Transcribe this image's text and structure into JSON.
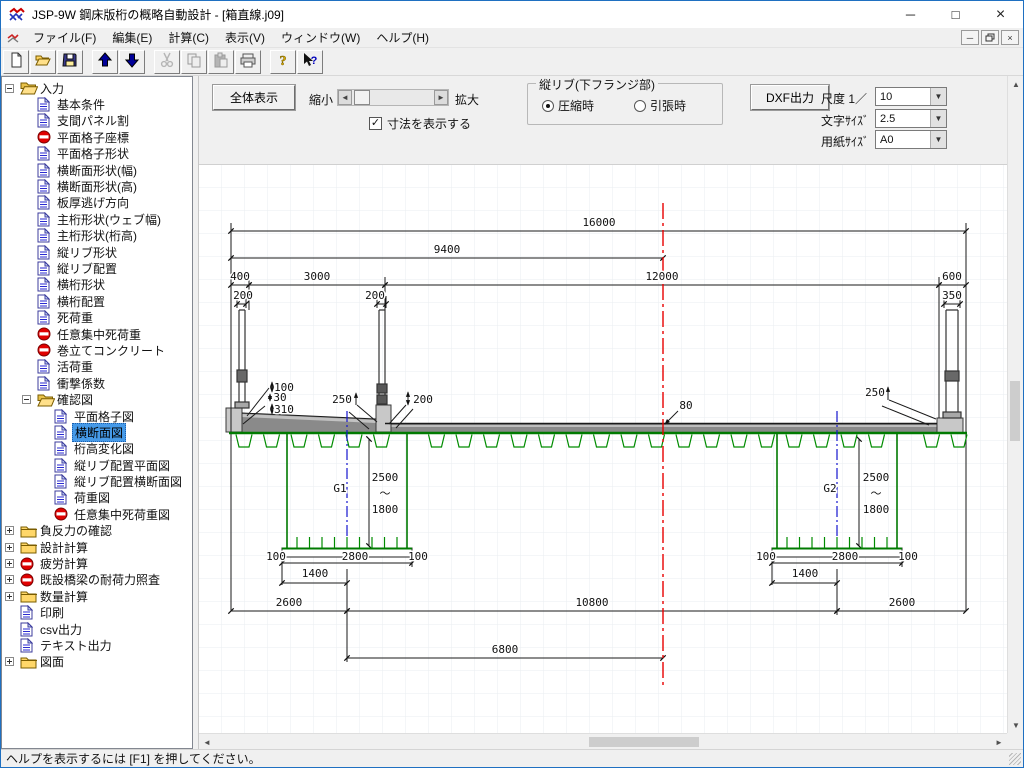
{
  "window": {
    "title": "JSP-9W 鋼床版桁の概略自動設計 - [箱直線.j09]",
    "controls": [
      "minimize",
      "maximize",
      "close"
    ]
  },
  "menu": {
    "items": [
      "ファイル(F)",
      "編集(E)",
      "計算(C)",
      "表示(V)",
      "ウィンドウ(W)",
      "ヘルプ(H)"
    ]
  },
  "toolbar": {
    "buttons": [
      {
        "name": "new",
        "disabled": false
      },
      {
        "name": "open",
        "disabled": false
      },
      {
        "name": "save",
        "disabled": false
      },
      {
        "name": "sep"
      },
      {
        "name": "move-up",
        "disabled": false
      },
      {
        "name": "move-down",
        "disabled": false
      },
      {
        "name": "sep"
      },
      {
        "name": "cut",
        "disabled": true
      },
      {
        "name": "copy",
        "disabled": true
      },
      {
        "name": "paste",
        "disabled": true
      },
      {
        "name": "print",
        "disabled": false
      },
      {
        "name": "sep"
      },
      {
        "name": "help",
        "disabled": false
      },
      {
        "name": "context-help",
        "disabled": false
      }
    ]
  },
  "tree": {
    "items": [
      {
        "l": "入力",
        "i": "folderOpen",
        "e": "minus",
        "v": 0
      },
      {
        "l": "基本条件",
        "i": "doc",
        "v": 1
      },
      {
        "l": "支間パネル割",
        "i": "doc",
        "v": 1
      },
      {
        "l": "平面格子座標",
        "i": "noentry",
        "v": 1
      },
      {
        "l": "平面格子形状",
        "i": "doc",
        "v": 1
      },
      {
        "l": "横断面形状(幅)",
        "i": "doc",
        "v": 1
      },
      {
        "l": "横断面形状(高)",
        "i": "doc",
        "v": 1
      },
      {
        "l": "板厚逃げ方向",
        "i": "doc",
        "v": 1
      },
      {
        "l": "主桁形状(ウェブ幅)",
        "i": "doc",
        "v": 1
      },
      {
        "l": "主桁形状(桁高)",
        "i": "doc",
        "v": 1
      },
      {
        "l": "縦リブ形状",
        "i": "doc",
        "v": 1
      },
      {
        "l": "縦リブ配置",
        "i": "doc",
        "v": 1
      },
      {
        "l": "横桁形状",
        "i": "doc",
        "v": 1
      },
      {
        "l": "横桁配置",
        "i": "doc",
        "v": 1
      },
      {
        "l": "死荷重",
        "i": "doc",
        "v": 1
      },
      {
        "l": "任意集中死荷重",
        "i": "noentry",
        "v": 1
      },
      {
        "l": "巻立てコンクリート",
        "i": "noentry",
        "v": 1
      },
      {
        "l": "活荷重",
        "i": "doc",
        "v": 1
      },
      {
        "l": "衝撃係数",
        "i": "doc",
        "v": 1
      },
      {
        "l": "確認図",
        "i": "folderOpen",
        "e": "minus",
        "v": 1
      },
      {
        "l": "平面格子図",
        "i": "doc",
        "v": 2
      },
      {
        "l": "横断面図",
        "i": "doc",
        "v": 2,
        "s": true
      },
      {
        "l": "桁高変化図",
        "i": "doc",
        "v": 2
      },
      {
        "l": "縦リブ配置平面図",
        "i": "doc",
        "v": 2
      },
      {
        "l": "縦リブ配置横断面図",
        "i": "doc",
        "v": 2
      },
      {
        "l": "荷重図",
        "i": "doc",
        "v": 2
      },
      {
        "l": "任意集中死荷重図",
        "i": "noentry",
        "v": 2
      },
      {
        "l": "負反力の確認",
        "i": "folderClosed",
        "e": "plus",
        "v": 0
      },
      {
        "l": "設計計算",
        "i": "folderClosed",
        "e": "plus",
        "v": 0
      },
      {
        "l": "疲労計算",
        "i": "noentry",
        "e": "plus",
        "v": 0
      },
      {
        "l": "既設橋梁の耐荷力照査",
        "i": "noentry",
        "e": "plus",
        "v": 0
      },
      {
        "l": "数量計算",
        "i": "folderClosed",
        "e": "plus",
        "v": 0
      },
      {
        "l": "印刷",
        "i": "doc",
        "v": 0
      },
      {
        "l": "csv出力",
        "i": "doc",
        "v": 0
      },
      {
        "l": "テキスト出力",
        "i": "doc",
        "v": 0
      },
      {
        "l": "図面",
        "i": "folderClosed",
        "e": "plus",
        "v": 0
      }
    ]
  },
  "controls": {
    "fit_button": "全体表示",
    "zoom_out": "縮小",
    "zoom_in": "拡大",
    "show_dims": "寸法を表示する",
    "group_title": "縦リブ(下フランジ部)",
    "radio_compress": "圧縮時",
    "radio_tension": "引張時",
    "dxf_button": "DXF出力",
    "scale_label": "尺度 1／",
    "scale_value": "10",
    "fontsize_label": "文字ｻｲｽﾞ",
    "fontsize_value": "2.5",
    "paper_label": "用紙ｻｲｽﾞ",
    "paper_value": "A0"
  },
  "drawing": {
    "girder_color": "#008000",
    "centerline_color": "#e80000",
    "girder_cl_color": "#1515cf",
    "labels": [
      {
        "t": "16000",
        "x": 400,
        "y": 61
      },
      {
        "t": "9400",
        "x": 248,
        "y": 88
      },
      {
        "t": "400",
        "x": 41,
        "y": 115
      },
      {
        "t": "3000",
        "x": 118,
        "y": 115
      },
      {
        "t": "12000",
        "x": 463,
        "y": 115
      },
      {
        "t": "600",
        "x": 753,
        "y": 115
      },
      {
        "t": "200",
        "x": 44,
        "y": 134
      },
      {
        "t": "200",
        "x": 176,
        "y": 134
      },
      {
        "t": "350",
        "x": 753,
        "y": 134
      },
      {
        "t": "100",
        "x": 85,
        "y": 226
      },
      {
        "t": "30",
        "x": 81,
        "y": 236
      },
      {
        "t": "310",
        "x": 85,
        "y": 248
      },
      {
        "t": "250",
        "x": 143,
        "y": 238
      },
      {
        "t": "200",
        "x": 224,
        "y": 238
      },
      {
        "t": "80",
        "x": 487,
        "y": 244
      },
      {
        "t": "250",
        "x": 676,
        "y": 231
      },
      {
        "t": "G1",
        "x": 141,
        "y": 327,
        "c": "#1515cf"
      },
      {
        "t": "2500",
        "x": 186,
        "y": 316
      },
      {
        "t": "〜",
        "x": 186,
        "y": 332
      },
      {
        "t": "1800",
        "x": 186,
        "y": 348
      },
      {
        "t": "G2",
        "x": 631,
        "y": 327,
        "c": "#1515cf"
      },
      {
        "t": "2500",
        "x": 677,
        "y": 316
      },
      {
        "t": "〜",
        "x": 677,
        "y": 332
      },
      {
        "t": "1800",
        "x": 677,
        "y": 348
      },
      {
        "t": "100",
        "x": 77,
        "y": 395
      },
      {
        "t": "2800",
        "x": 156,
        "y": 395
      },
      {
        "t": "100",
        "x": 219,
        "y": 395
      },
      {
        "t": "1400",
        "x": 116,
        "y": 412
      },
      {
        "t": "100",
        "x": 567,
        "y": 395
      },
      {
        "t": "2800",
        "x": 646,
        "y": 395
      },
      {
        "t": "100",
        "x": 709,
        "y": 395
      },
      {
        "t": "1400",
        "x": 606,
        "y": 412
      },
      {
        "t": "2600",
        "x": 90,
        "y": 441
      },
      {
        "t": "10800",
        "x": 393,
        "y": 441
      },
      {
        "t": "2600",
        "x": 703,
        "y": 441
      },
      {
        "t": "6800",
        "x": 306,
        "y": 488
      }
    ]
  },
  "statusbar": {
    "text": "ヘルプを表示するには [F1] を押してください。"
  }
}
